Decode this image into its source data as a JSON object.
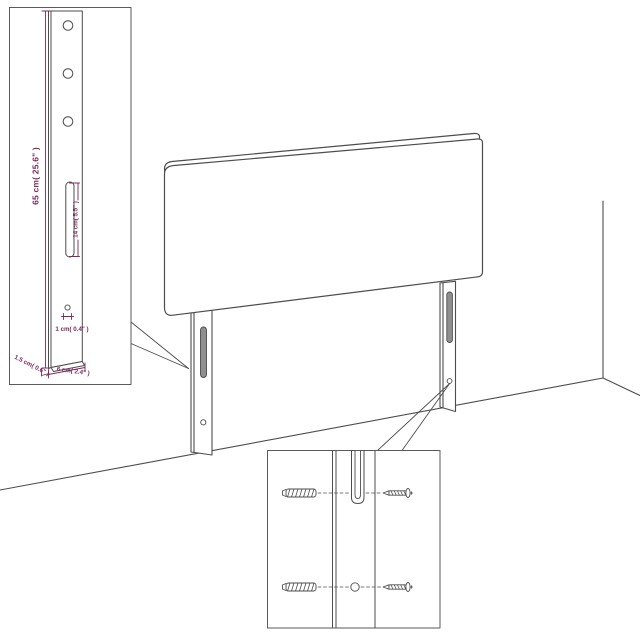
{
  "diagram": {
    "type": "product-assembly-diagram",
    "subject": "headboard with mounting legs, wall corner scene, two detail insets",
    "accent_color": "#7d2a5a",
    "line_color": "#4d4d4d",
    "slot_fill_color": "#8f8f8f",
    "labels": {
      "leg_height": "65 cm( 25.6\" )",
      "slot_length": "14 cm( 5.5\" )",
      "hole_diameter": "1 cm( 0.4\" )",
      "leg_thickness": "1.5 cm( 0.6\" )",
      "leg_width": "6 cm( 2.4\" )"
    }
  }
}
